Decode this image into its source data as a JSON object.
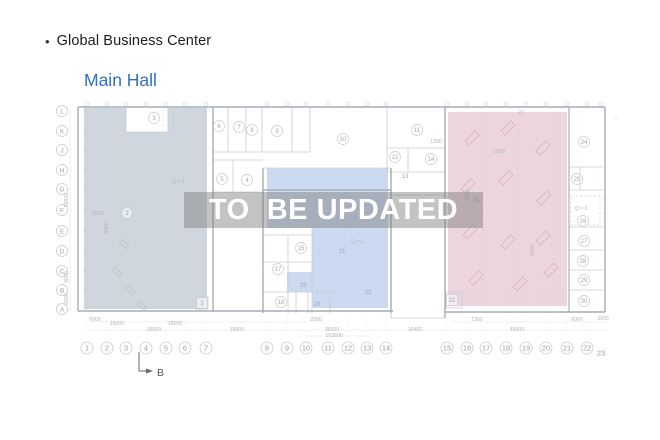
{
  "header": {
    "bullet": "•",
    "title": "Global Business Center",
    "subtitle": "Main Hall"
  },
  "watermark": {
    "text": "TO  BE UPDATED"
  },
  "colors": {
    "left_zone": "#cdd4db",
    "middle_zone": "#c5d6f0",
    "right_zone": "#ecd3dd",
    "subtitle_blue": "#2f70c5",
    "watermark_text": "#ffffff"
  },
  "plan": {
    "section_marker": {
      "label": "B"
    },
    "row_labels": [
      {
        "label": "L",
        "y": 111
      },
      {
        "label": "K",
        "y": 131
      },
      {
        "label": "J",
        "y": 150
      },
      {
        "label": "H",
        "y": 170
      },
      {
        "label": "G",
        "y": 189
      },
      {
        "label": "F",
        "y": 210
      },
      {
        "label": "E",
        "y": 231
      },
      {
        "label": "D",
        "y": 251
      },
      {
        "label": "C",
        "y": 271
      },
      {
        "label": "B",
        "y": 290
      },
      {
        "label": "A",
        "y": 309
      }
    ],
    "col_labels": [
      {
        "label": "1",
        "x": 87
      },
      {
        "label": "2",
        "x": 107
      },
      {
        "label": "3",
        "x": 126
      },
      {
        "label": "4",
        "x": 146
      },
      {
        "label": "5",
        "x": 166
      },
      {
        "label": "6",
        "x": 185
      },
      {
        "label": "7",
        "x": 206
      },
      {
        "label": "8",
        "x": 267
      },
      {
        "label": "9",
        "x": 287
      },
      {
        "label": "10",
        "x": 306
      },
      {
        "label": "11",
        "x": 328
      },
      {
        "label": "12",
        "x": 348
      },
      {
        "label": "13",
        "x": 367
      },
      {
        "label": "14",
        "x": 386
      },
      {
        "label": "15",
        "x": 447
      },
      {
        "label": "16",
        "x": 467
      },
      {
        "label": "17",
        "x": 486
      },
      {
        "label": "18",
        "x": 506
      },
      {
        "label": "19",
        "x": 526
      },
      {
        "label": "20",
        "x": 546
      },
      {
        "label": "21",
        "x": 567
      },
      {
        "label": "22",
        "x": 587
      },
      {
        "label": "23",
        "x": 601,
        "y": 353,
        "circled": false
      }
    ],
    "room_labels": [
      {
        "n": "3",
        "x": 154,
        "y": 118,
        "style": "circle"
      },
      {
        "n": "6",
        "x": 219,
        "y": 126,
        "style": "circle"
      },
      {
        "n": "7",
        "x": 239,
        "y": 127,
        "style": "circle"
      },
      {
        "n": "8",
        "x": 252,
        "y": 130,
        "style": "circle"
      },
      {
        "n": "9",
        "x": 277,
        "y": 131,
        "style": "circle"
      },
      {
        "n": "10",
        "x": 343,
        "y": 139,
        "style": "circle"
      },
      {
        "n": "11",
        "x": 417,
        "y": 130,
        "style": "circle"
      },
      {
        "n": "12",
        "x": 395,
        "y": 157,
        "style": "circle"
      },
      {
        "n": "14",
        "x": 431,
        "y": 159,
        "style": "circle"
      },
      {
        "n": "13",
        "x": 405,
        "y": 176,
        "style": "plain"
      },
      {
        "n": "5",
        "x": 222,
        "y": 179,
        "style": "circle"
      },
      {
        "n": "4",
        "x": 247,
        "y": 180,
        "style": "circle"
      },
      {
        "n": "2",
        "x": 127,
        "y": 213,
        "style": "circle"
      },
      {
        "n": "1",
        "x": 202,
        "y": 303,
        "style": "box"
      },
      {
        "n": "15",
        "x": 301,
        "y": 248,
        "style": "circle"
      },
      {
        "n": "17",
        "x": 278,
        "y": 269,
        "style": "circle"
      },
      {
        "n": "18",
        "x": 281,
        "y": 302,
        "style": "circle"
      },
      {
        "n": "19",
        "x": 303,
        "y": 285,
        "style": "plain"
      },
      {
        "n": "20",
        "x": 317,
        "y": 304,
        "style": "plain"
      },
      {
        "n": "21",
        "x": 342,
        "y": 251,
        "style": "plain"
      },
      {
        "n": "22",
        "x": 368,
        "y": 292,
        "style": "plain"
      },
      {
        "n": "31",
        "x": 477,
        "y": 200,
        "style": "plain"
      },
      {
        "n": "32",
        "x": 452,
        "y": 300,
        "style": "box"
      },
      {
        "n": "24",
        "x": 584,
        "y": 142,
        "style": "circle"
      },
      {
        "n": "25",
        "x": 577,
        "y": 179,
        "style": "circle"
      },
      {
        "n": "26",
        "x": 583,
        "y": 221,
        "style": "circle"
      },
      {
        "n": "27",
        "x": 584,
        "y": 241,
        "style": "circle"
      },
      {
        "n": "28",
        "x": 583,
        "y": 261,
        "style": "circle"
      },
      {
        "n": "29",
        "x": 584,
        "y": 280,
        "style": "circle"
      },
      {
        "n": "30",
        "x": 584,
        "y": 301,
        "style": "circle"
      }
    ],
    "dimensions": [
      {
        "text": "6000",
        "x": 95,
        "y": 321
      },
      {
        "text": "2000",
        "x": 316,
        "y": 321
      },
      {
        "text": "1300",
        "x": 477,
        "y": 321
      },
      {
        "text": "6000",
        "x": 577,
        "y": 321
      },
      {
        "text": "3000",
        "x": 603,
        "y": 320
      },
      {
        "text": "18000",
        "x": 117,
        "y": 325
      },
      {
        "text": "18000",
        "x": 175,
        "y": 325
      },
      {
        "text": "36000",
        "x": 154,
        "y": 331
      },
      {
        "text": "18000",
        "x": 237,
        "y": 331
      },
      {
        "text": "36000",
        "x": 332,
        "y": 331
      },
      {
        "text": "18400",
        "x": 415,
        "y": 331
      },
      {
        "text": "45000",
        "x": 517,
        "y": 331
      },
      {
        "text": "153600",
        "x": 334,
        "y": 337
      }
    ],
    "small_texts": [
      {
        "text": "Q = 3",
        "x": 178,
        "y": 183
      },
      {
        "text": "Q = 3",
        "x": 357,
        "y": 243
      },
      {
        "text": "Q = 3",
        "x": 581,
        "y": 210
      },
      {
        "text": "2000",
        "x": 98,
        "y": 215
      },
      {
        "text": "1300",
        "x": 436,
        "y": 143
      },
      {
        "text": "1900",
        "x": 499,
        "y": 153
      },
      {
        "text": "23",
        "x": 521,
        "y": 114
      },
      {
        "text": "–",
        "x": 616,
        "y": 119
      },
      {
        "text": "60000",
        "x": 68,
        "y": 200,
        "rot": true
      },
      {
        "text": "5000",
        "x": 108,
        "y": 228,
        "rot": true
      },
      {
        "text": "6000",
        "x": 68,
        "y": 277,
        "rot": true
      },
      {
        "text": "6000",
        "x": 68,
        "y": 299,
        "rot": true
      },
      {
        "text": "6000",
        "x": 469,
        "y": 195,
        "rot": true
      },
      {
        "text": "6000",
        "x": 534,
        "y": 250,
        "rot": true
      }
    ]
  }
}
